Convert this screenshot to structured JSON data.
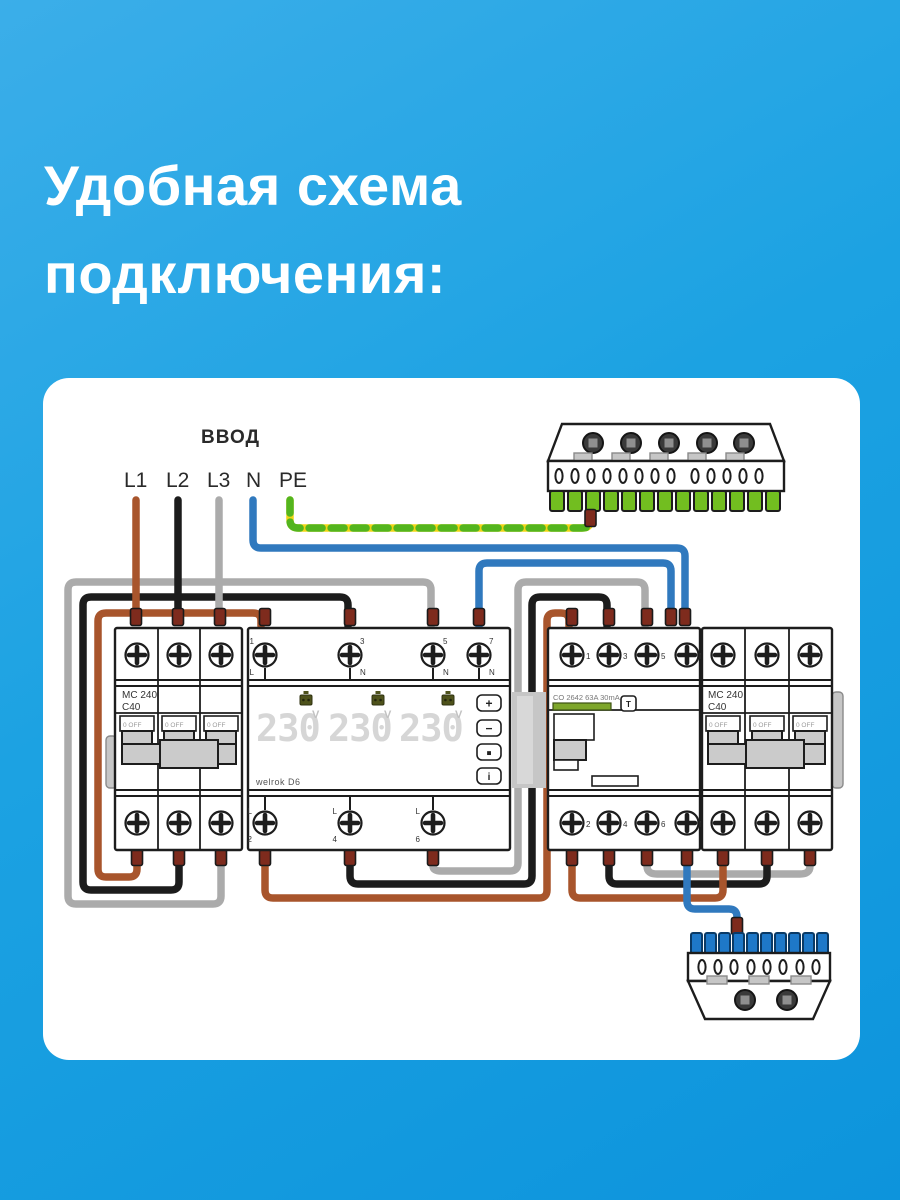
{
  "title": {
    "line1": "Удобная схема",
    "line2": "подключения:"
  },
  "diagram": {
    "input_label": "ВВОД",
    "phase_labels": [
      "L1",
      "L2",
      "L3",
      "N",
      "PE"
    ],
    "left_breaker": {
      "model": "MC 240",
      "rating": "C40",
      "off_label": "0 OFF"
    },
    "relay": {
      "brand": "welrok D6",
      "display_values": [
        "230",
        "230",
        "230"
      ],
      "display_unit": "V",
      "buttons": [
        "+",
        "−",
        "■",
        "i"
      ],
      "top_terminal_nums": [
        "1",
        "3",
        "5",
        "7"
      ],
      "top_terminal_letters": [
        "L",
        "N",
        "N",
        "N"
      ],
      "bottom_terminal_letters": [
        "L",
        "L",
        "L"
      ],
      "bottom_terminal_nums": [
        "2",
        "4",
        "6"
      ]
    },
    "rcd": {
      "model": "CO 2642 63A 30mA",
      "test_button": "T",
      "top_terminals": [
        "1",
        "3",
        "5",
        "N"
      ],
      "bottom_terminals": [
        "2",
        "4",
        "6",
        "N"
      ]
    },
    "right_breaker": {
      "model": "MC 240",
      "rating": "C40",
      "off_label": "0 OFF"
    },
    "colors": {
      "wire_l1": "#A8552C",
      "wire_l2": "#1C1C1C",
      "wire_l3": "#ABABAB",
      "wire_n": "#3079BE",
      "wire_pe_yellow": "#F0D515",
      "wire_pe_green": "#53B51E",
      "pe_bus_teeth": "#72BE20",
      "n_bus_teeth": "#1E78C8",
      "terminal_connector": "#7E2B1D",
      "background_top": "#3BAEE9",
      "background_bottom": "#0D94DC"
    }
  }
}
